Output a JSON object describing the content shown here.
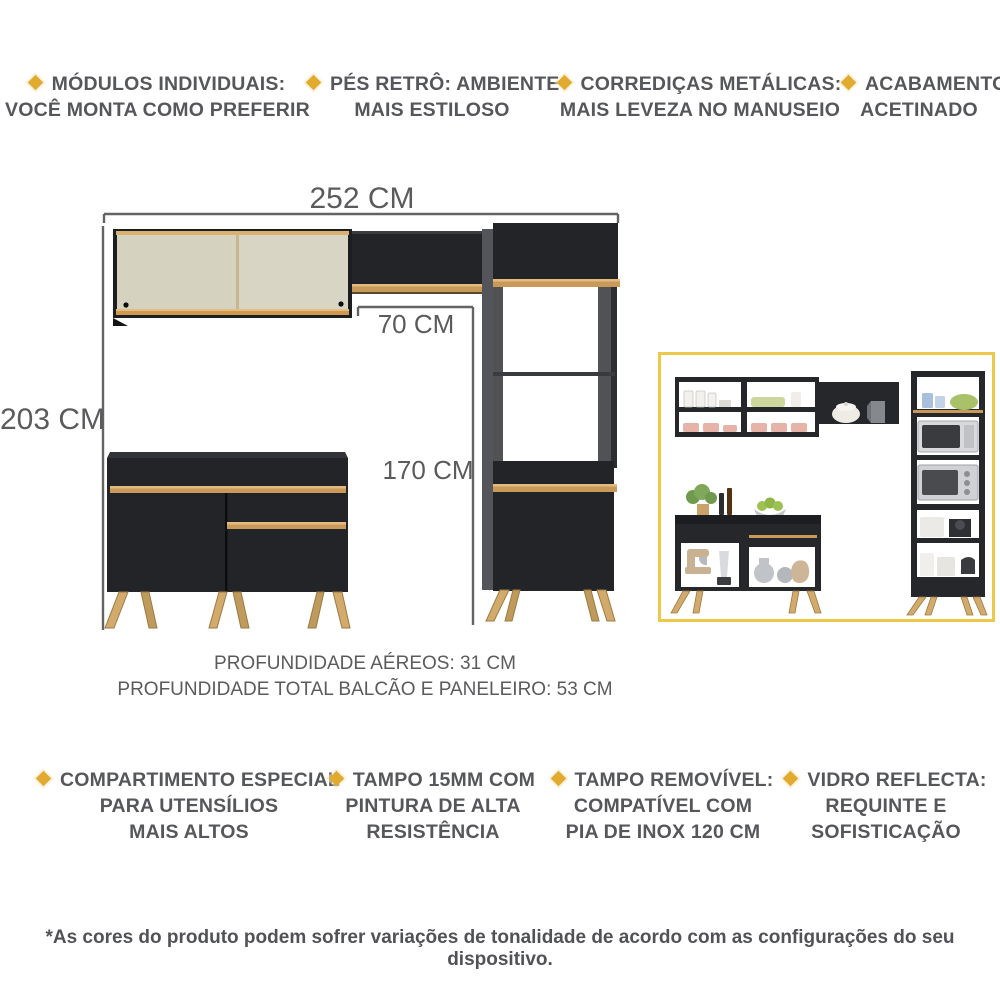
{
  "features_top": [
    {
      "lines": [
        "MÓDULOS INDIVIDUAIS:",
        "VOCÊ MONTA COMO PREFERIR"
      ]
    },
    {
      "lines": [
        "PÉS RETRÔ: AMBIENTE",
        "MAIS ESTILOSO"
      ]
    },
    {
      "lines": [
        "CORREDIÇAS METÁLICAS:",
        "MAIS LEVEZA NO MANUSEIO"
      ]
    },
    {
      "lines": [
        "ACABAMENTO",
        "ACETINADO"
      ]
    }
  ],
  "features_bottom": [
    {
      "lines": [
        "COMPARTIMENTO ESPECIAL",
        "PARA UTENSÍLIOS",
        "MAIS ALTOS"
      ]
    },
    {
      "lines": [
        "TAMPO 15MM COM",
        "PINTURA DE ALTA",
        "RESISTÊNCIA"
      ]
    },
    {
      "lines": [
        "TAMPO REMOVÍVEL:",
        "COMPATÍVEL COM",
        "PIA DE INOX 120 CM"
      ]
    },
    {
      "lines": [
        "VIDRO REFLECTA:",
        "REQUINTE E",
        "SOFISTICAÇÃO"
      ]
    }
  ],
  "dimensions": {
    "width_total": "252 CM",
    "height_total": "203 CM",
    "width_upper": "70 CM",
    "height_tower": "170 CM"
  },
  "depth_notes": [
    "PROFUNDIDADE AÉREOS: 31 CM",
    "PROFUNDIDADE TOTAL BALCÃO E PANELEIRO: 53 CM"
  ],
  "disclaimer": "*As cores do produto podem sofrer variações de tonalidade de acordo com as configurações do seu dispositivo.",
  "colors": {
    "accent_diamond": "#e2aa2e",
    "text_gray": "#56575a",
    "dim_gray": "#5b5b5e",
    "cabinet_black": "#232428",
    "trim_gold": "#c9995a",
    "door_cream": "#d9d5c4",
    "leg_tan": "#d2ab6c",
    "inset_frame_yellow": "#ecc94b"
  }
}
